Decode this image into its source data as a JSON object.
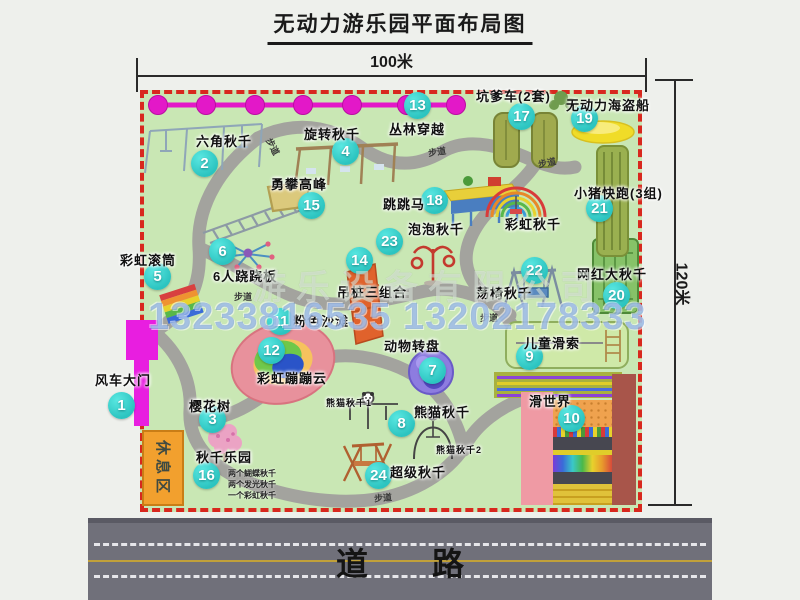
{
  "title": "无动力游乐园平面布局图",
  "dimensions": {
    "width_label": "100米",
    "height_label": "120米"
  },
  "road": {
    "label": "道路"
  },
  "rest_area": {
    "label": "休息区"
  },
  "watermark": {
    "company": "游乐设备有限公司",
    "phone": "13233816535 13202178333"
  },
  "colors": {
    "park_green": "#c9e7b4",
    "border_red": "#d8281e",
    "badge_teal": "#2fc8c4",
    "gate_magenta": "#e81ee0",
    "zipline_magenta": "#e318c8",
    "road_gray": "#70707a",
    "rest_area_orange": "#f2a02e"
  },
  "path_label_text": "步道",
  "attractions": [
    {
      "num": 1,
      "name": "风车大门",
      "bx": 122,
      "by": 406,
      "lx": 95,
      "ly": 370
    },
    {
      "num": 2,
      "name": "六角秋千",
      "bx": 205,
      "by": 164,
      "lx": 196,
      "ly": 131
    },
    {
      "num": 3,
      "name": "樱花树",
      "bx": 213,
      "by": 420,
      "lx": 189,
      "ly": 396
    },
    {
      "num": 4,
      "name": "旋转秋千",
      "bx": 346,
      "by": 152,
      "lx": 304,
      "ly": 124
    },
    {
      "num": 5,
      "name": "彩虹滚筒",
      "bx": 158,
      "by": 277,
      "lx": 120,
      "ly": 250
    },
    {
      "num": 6,
      "name": "6人跷跷板",
      "bx": 223,
      "by": 252,
      "lx": 213,
      "ly": 266
    },
    {
      "num": 7,
      "name": "动物转盘",
      "bx": 433,
      "by": 371,
      "lx": 384,
      "ly": 336
    },
    {
      "num": 8,
      "name": "熊猫秋千",
      "bx": 402,
      "by": 424,
      "lx": 414,
      "ly": 402
    },
    {
      "num": 9,
      "name": "儿童滑索",
      "bx": 530,
      "by": 357,
      "lx": 524,
      "ly": 333
    },
    {
      "num": 10,
      "name": "滑世界",
      "bx": 572,
      "by": 419,
      "lx": 529,
      "ly": 391
    },
    {
      "num": 11,
      "name": "粉色沙滩",
      "bx": 281,
      "by": 322,
      "lx": 293,
      "ly": 311
    },
    {
      "num": 12,
      "name": "彩虹蹦蹦云",
      "bx": 272,
      "by": 351,
      "lx": 257,
      "ly": 368
    },
    {
      "num": 13,
      "name": "丛林穿越",
      "bx": 418,
      "by": 106,
      "lx": 389,
      "ly": 119
    },
    {
      "num": 14,
      "name": "吊桩三组合",
      "bx": 360,
      "by": 261,
      "lx": 337,
      "ly": 282
    },
    {
      "num": 15,
      "name": "勇攀高峰",
      "bx": 312,
      "by": 206,
      "lx": 271,
      "ly": 174
    },
    {
      "num": 16,
      "name": "秋千乐园",
      "bx": 207,
      "by": 476,
      "lx": 196,
      "ly": 447
    },
    {
      "num": 17,
      "name": "坑爹车(2套)",
      "bx": 522,
      "by": 117,
      "lx": 476,
      "ly": 86
    },
    {
      "num": 18,
      "name": "跳跳马",
      "bx": 435,
      "by": 201,
      "lx": 383,
      "ly": 194
    },
    {
      "num": 19,
      "name": "无动力海盗船",
      "bx": 585,
      "by": 119,
      "lx": 566,
      "ly": 95
    },
    {
      "num": 20,
      "name": "网红大秋千",
      "bx": 617,
      "by": 296,
      "lx": 577,
      "ly": 264
    },
    {
      "num": 21,
      "name": "小猪快跑(3组)",
      "bx": 600,
      "by": 209,
      "lx": 574,
      "ly": 183
    },
    {
      "num": 22,
      "name": "荡椅秋千",
      "bx": 535,
      "by": 271,
      "lx": 476,
      "ly": 283
    },
    {
      "num": 23,
      "name": "泡泡秋千",
      "bx": 390,
      "by": 242,
      "lx": 408,
      "ly": 219
    },
    {
      "num": 24,
      "name": "超级秋千",
      "bx": 379,
      "by": 476,
      "lx": 390,
      "ly": 462
    }
  ],
  "extra_labels": [
    {
      "text": "彩虹秋千",
      "x": 505,
      "y": 214,
      "size": 13
    },
    {
      "text": "熊猫秋千1",
      "x": 326,
      "y": 396,
      "size": 9
    },
    {
      "text": "熊猫秋千2",
      "x": 436,
      "y": 443,
      "size": 9
    }
  ],
  "path_labels": [
    {
      "x": 264,
      "y": 140,
      "rot": 62
    },
    {
      "x": 428,
      "y": 145,
      "rot": -8
    },
    {
      "x": 538,
      "y": 156,
      "rot": -12
    },
    {
      "x": 234,
      "y": 290,
      "rot": 0
    },
    {
      "x": 480,
      "y": 311,
      "rot": 0
    },
    {
      "x": 374,
      "y": 491,
      "rot": -5
    }
  ],
  "swing_notes": [
    "两个蝴蝶秋千",
    "两个发光秋千",
    "一个彩虹秋千"
  ]
}
